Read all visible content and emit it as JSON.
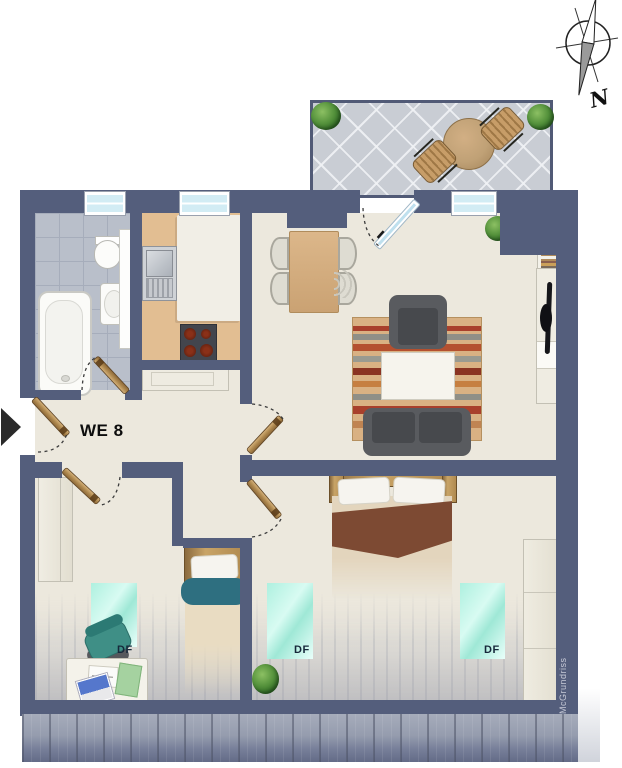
{
  "labels": {
    "unit": "WE 8",
    "north": "N",
    "watermark": "McGrundriss"
  },
  "roof_windows": [
    {
      "label": "DF"
    },
    {
      "label": "DF"
    },
    {
      "label": "DF"
    }
  ],
  "colors": {
    "wall": "#545e7c",
    "floor": "#ece8dd",
    "kitchen_floor": "#e2be92",
    "bath_tile": "#b9bfca",
    "terrace_tile": "#c9cdd4",
    "skylight": "#aef0df",
    "window_glass": "#d2ecf4",
    "door_wood": "#c49a62",
    "teal_accent": "#2e7080",
    "rug_base": "#d9b183",
    "sofa_gray": "#595b5f",
    "blanket_brown": "#7d4a33",
    "roof_slope": "#8b92a5"
  },
  "rooms": [
    {
      "name": "bathroom"
    },
    {
      "name": "kitchen"
    },
    {
      "name": "hallway"
    },
    {
      "name": "living-room"
    },
    {
      "name": "bedroom"
    },
    {
      "name": "kids-room"
    },
    {
      "name": "bed-niche"
    },
    {
      "name": "terrace"
    }
  ]
}
